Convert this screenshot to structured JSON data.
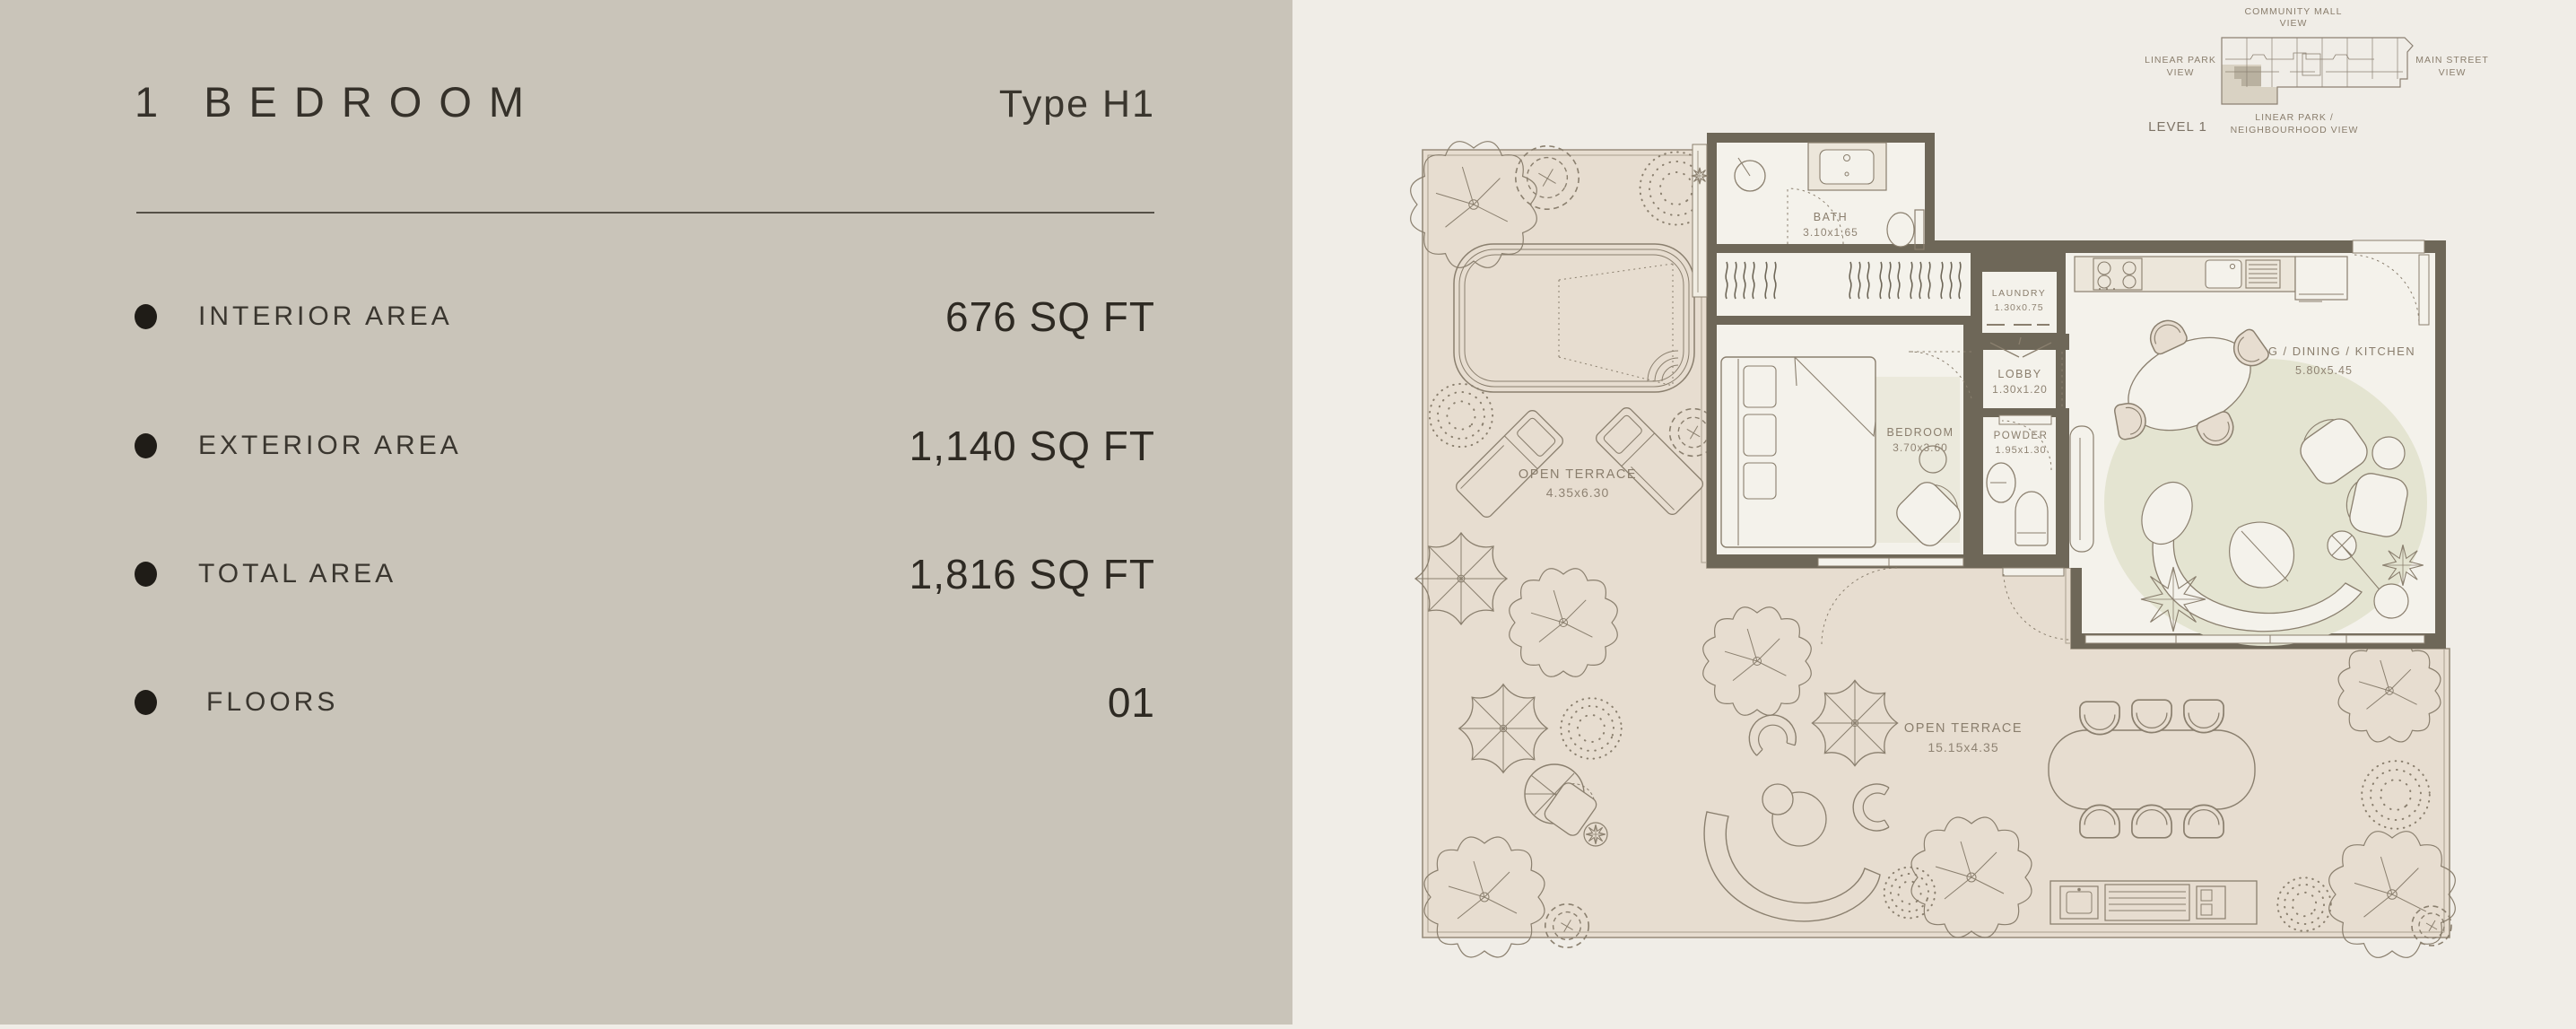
{
  "left_panel": {
    "title": "1 BEDROOM",
    "type_label": "Type H1",
    "rows": [
      {
        "label": "INTERIOR AREA",
        "value": "676 SQ FT"
      },
      {
        "label": "EXTERIOR AREA",
        "value": "1,140 SQ FT"
      },
      {
        "label": "TOTAL AREA",
        "value": "1,816 SQ FT"
      },
      {
        "label": "FLOORS",
        "value": "01"
      }
    ]
  },
  "floor_plan": {
    "rooms": [
      {
        "name": "BATH",
        "dims": "3.10x1.65"
      },
      {
        "name": "LAUNDRY",
        "dims": "1.30x0.75"
      },
      {
        "name": "LOBBY",
        "dims": "1.30x1.20"
      },
      {
        "name": "BEDROOM",
        "dims": "3.70x3.60"
      },
      {
        "name": "POWDER",
        "dims": "1.95x1.30"
      },
      {
        "name": "LIVING / DINING / KITCHEN",
        "dims": "5.80x5.45"
      },
      {
        "name": "OPEN TERRACE",
        "dims": "4.35x6.30"
      },
      {
        "name": "OPEN TERRACE",
        "dims": "15.15x4.35"
      }
    ]
  },
  "locator": {
    "level": "LEVEL 1",
    "top_line1": "COMMUNITY MALL",
    "top_line2": "VIEW",
    "left_line1": "LINEAR PARK",
    "left_line2": "VIEW",
    "right_line1": "MAIN STREET",
    "right_line2": "VIEW",
    "bottom_line1": "LINEAR PARK /",
    "bottom_line2": "NEIGHBOURHOOD VIEW"
  },
  "colors": {
    "left_panel_bg": "#c9c4b9",
    "page_bg": "#f0ede7",
    "terrace": "#e7ddd0",
    "unit_floor": "#f4f2eb",
    "wall": "#6e6758",
    "line": "#8a7f6e",
    "rug": "#e4e4d1",
    "text_dark": "#37332b",
    "plan_text": "#8a7e6d"
  }
}
